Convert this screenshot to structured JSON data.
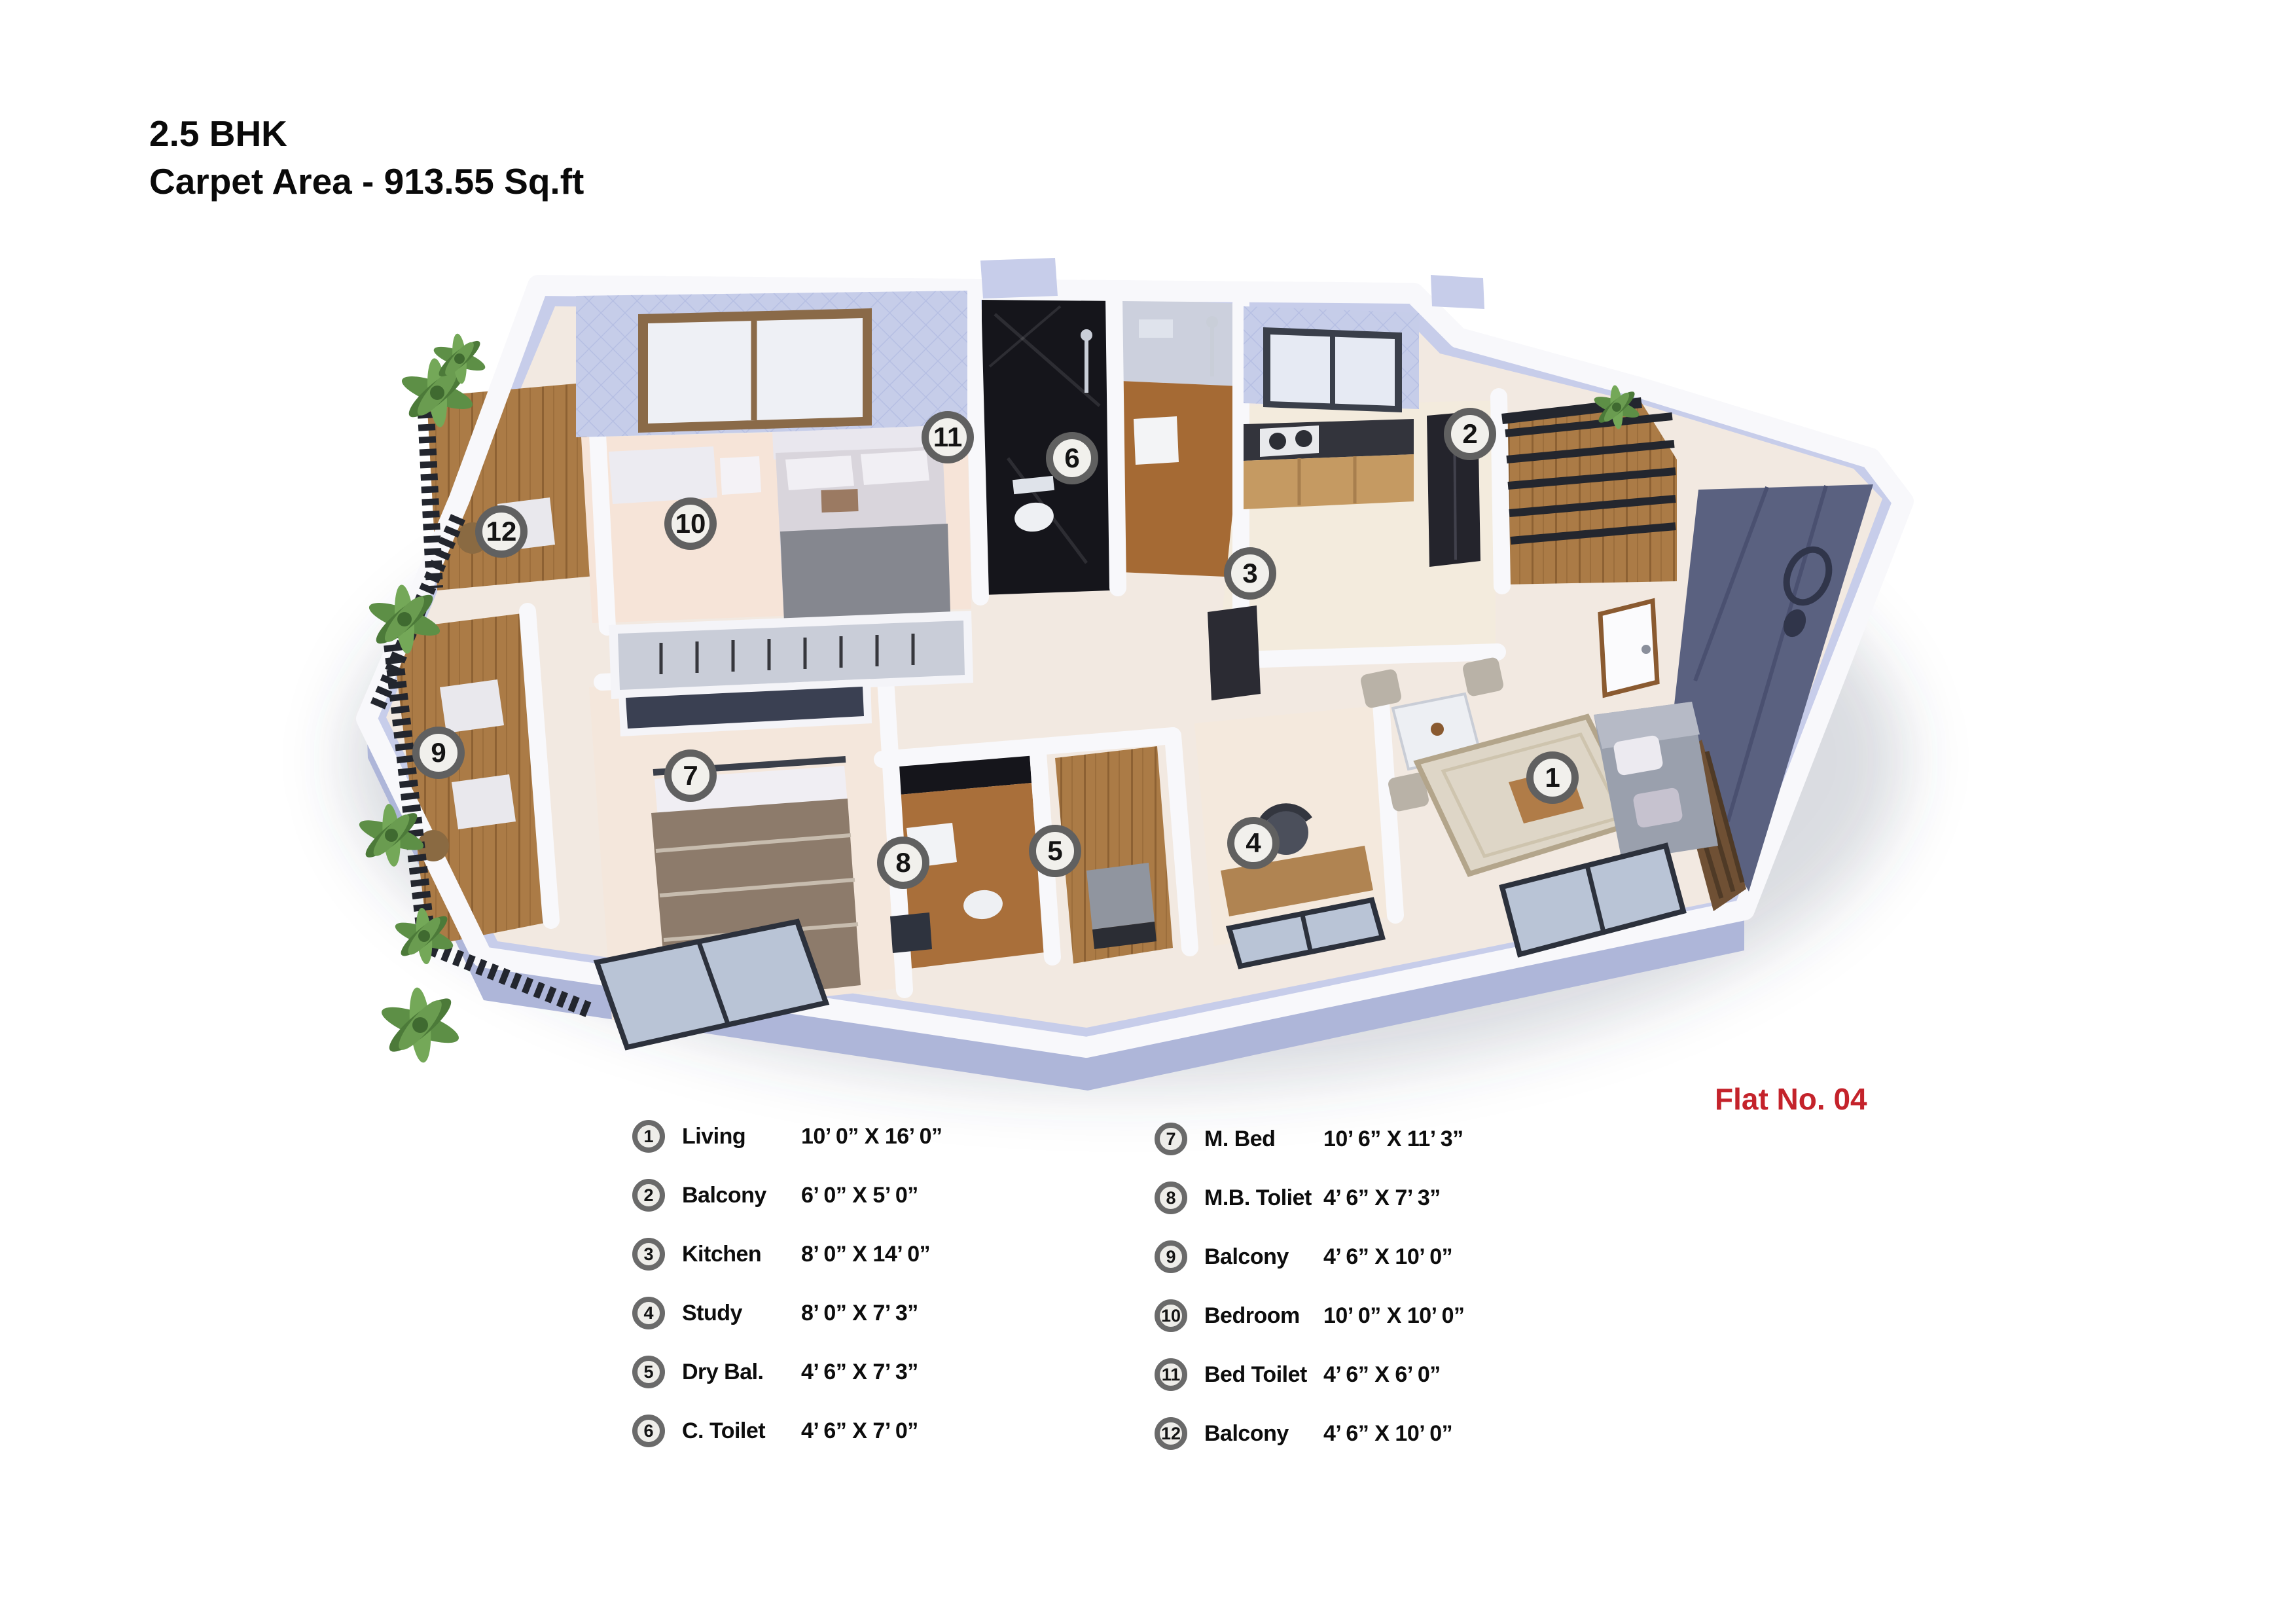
{
  "header": {
    "title": "2.5 BHK",
    "subtitle": "Carpet Area - 913.55 Sq.ft"
  },
  "flat_label": "Flat No. 04",
  "colors": {
    "flat_label_red": "#c4232b",
    "badge_ring": "#606060",
    "badge_fill": "#f1f0ec",
    "exterior_slab": "#c7cdea",
    "wall_white": "#f8f8fb",
    "floor_cream": "#f2e9e1",
    "accent_navy": "#5a6180",
    "wood": "#ab7b46",
    "dark_marble": "#15151b"
  },
  "plan": {
    "badges": [
      {
        "n": "1"
      },
      {
        "n": "2"
      },
      {
        "n": "3"
      },
      {
        "n": "4"
      },
      {
        "n": "5"
      },
      {
        "n": "6"
      },
      {
        "n": "7"
      },
      {
        "n": "8"
      },
      {
        "n": "9"
      },
      {
        "n": "10"
      },
      {
        "n": "11"
      },
      {
        "n": "12"
      }
    ]
  },
  "legend": {
    "left": [
      {
        "num": "1",
        "label": "Living",
        "size": "10’ 0” X 16’ 0”"
      },
      {
        "num": "2",
        "label": "Balcony",
        "size": "6’ 0” X 5’ 0”"
      },
      {
        "num": "3",
        "label": "Kitchen",
        "size": "8’ 0” X 14’ 0”"
      },
      {
        "num": "4",
        "label": "Study",
        "size": "8’ 0” X 7’ 3”"
      },
      {
        "num": "5",
        "label": "Dry Bal.",
        "size": "4’ 6” X 7’ 3”"
      },
      {
        "num": "6",
        "label": "C. Toilet",
        "size": "4’ 6” X 7’ 0”"
      }
    ],
    "right": [
      {
        "num": "7",
        "label": "M. Bed",
        "size": "10’ 6” X 11’ 3”"
      },
      {
        "num": "8",
        "label": "M.B. Toliet",
        "size": "4’ 6” X 7’ 3”"
      },
      {
        "num": "9",
        "label": "Balcony",
        "size": "4’ 6” X 10’ 0”"
      },
      {
        "num": "10",
        "label": "Bedroom",
        "size": "10’ 0” X 10’ 0”"
      },
      {
        "num": "11",
        "label": "Bed Toilet",
        "size": "4’ 6” X 6’ 0”"
      },
      {
        "num": "12",
        "label": "Balcony",
        "size": "4’ 6” X 10’ 0”"
      }
    ]
  }
}
